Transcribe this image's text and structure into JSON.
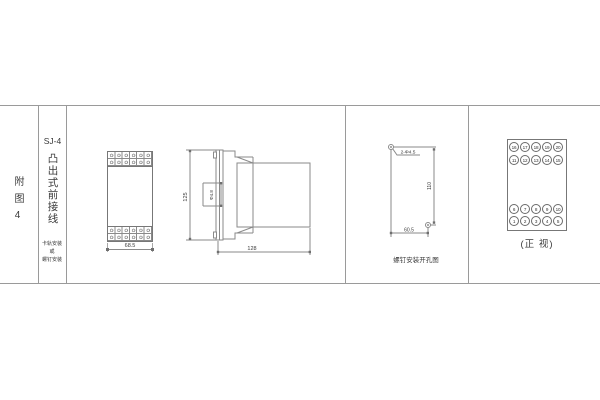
{
  "sheet": {
    "bg": "#ffffff",
    "line_color": "#8a8a8a",
    "ink": "#3a3a3a"
  },
  "sidebar": {
    "figure_label": "附图4",
    "model": "SJ-4",
    "product_title": "凸出式前接线",
    "mounting_lines": [
      "卡轨安装",
      "或",
      "螺钉安装"
    ]
  },
  "front_view": {
    "width_dim": "68.5"
  },
  "side_view": {
    "height_dim": "125",
    "hole_dim": "Φ4.8",
    "depth_dim": "128"
  },
  "drill_view": {
    "holes_label": "2-Φ4.5",
    "height_dim": "110",
    "width_dim": "60.5",
    "caption": "螺钉安装开孔图"
  },
  "terminal_view": {
    "rows": [
      [
        "16",
        "17",
        "18",
        "19",
        "20"
      ],
      [
        "11",
        "12",
        "13",
        "14",
        "15"
      ],
      [
        "6",
        "7",
        "8",
        "9",
        "10"
      ],
      [
        "1",
        "2",
        "3",
        "4",
        "5"
      ]
    ],
    "caption": "(正 视)"
  }
}
